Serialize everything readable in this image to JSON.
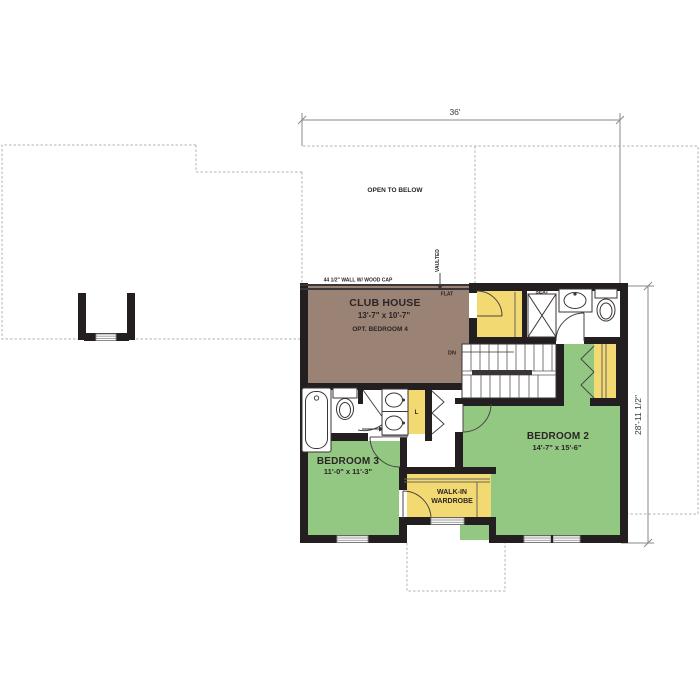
{
  "title": "Second floor plan",
  "colors": {
    "club_house": "#9a8274",
    "bedroom_green": "#92c882",
    "closet_yellow": "#f2d971",
    "wall_black": "#231f20",
    "outline_gray": "#b3b0ad",
    "dimension_gray": "#8a8a8a"
  },
  "rooms": {
    "open_below": {
      "name": "OPEN TO BELOW"
    },
    "club_house": {
      "name": "CLUB HOUSE",
      "dims": "13'-7\" x 10'-7\"",
      "note": "OPT. BEDROOM 4"
    },
    "bedroom_2": {
      "name": "BEDROOM 2",
      "dims": "14'-7\" x 15'-6\""
    },
    "bedroom_3": {
      "name": "BEDROOM 3",
      "dims": "11'-0\" x 11'-3\""
    },
    "wardrobe": {
      "line1": "WALK-IN",
      "line2": "WARDROBE"
    }
  },
  "annotations": {
    "wall_cap": "44 1/2\" WALL W/ WOOD CAP",
    "flat": "FLAT",
    "vaulted": "VAULTED",
    "seat": "SEAT",
    "down": "DN",
    "linen": "L"
  },
  "dimensions": {
    "width": "36'",
    "height": "28'-11 1/2\""
  }
}
